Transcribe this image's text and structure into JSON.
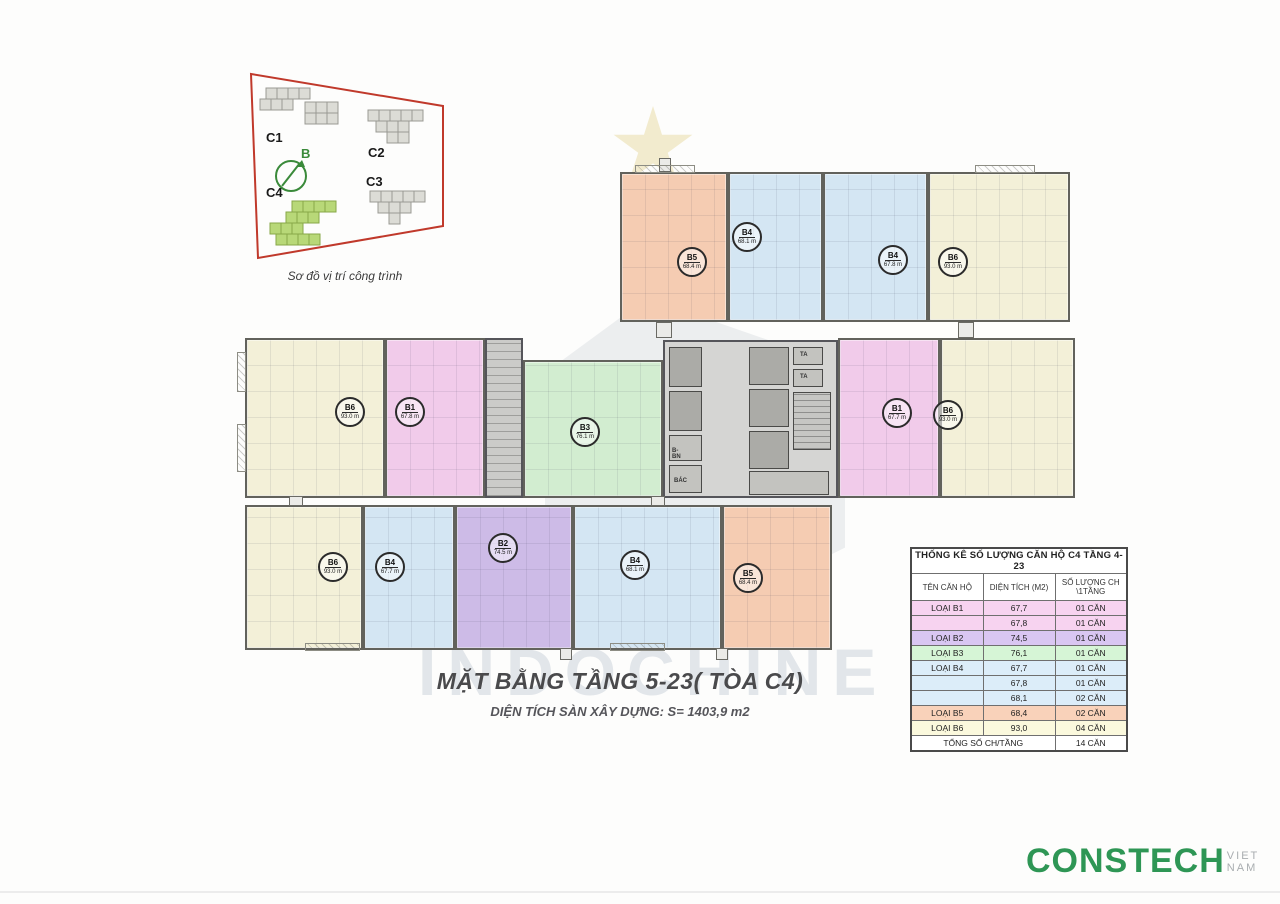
{
  "site_plan": {
    "caption": "Sơ đồ vị trí công trình",
    "labels": {
      "c1": "C1",
      "c2": "C2",
      "c3": "C3",
      "c4": "C4",
      "north": "B"
    }
  },
  "plan": {
    "units": [
      {
        "type": "B5",
        "area": "68.4 m",
        "color": "salmon",
        "x": 620,
        "y": 172,
        "w": 108,
        "h": 150,
        "bx": 692,
        "by": 262
      },
      {
        "type": "B4",
        "area": "68.1 m",
        "color": "blue",
        "x": 728,
        "y": 172,
        "w": 95,
        "h": 150,
        "bx": 747,
        "by": 237
      },
      {
        "type": "B4",
        "area": "67.8 m",
        "color": "blue",
        "x": 823,
        "y": 172,
        "w": 105,
        "h": 150,
        "bx": 893,
        "by": 260
      },
      {
        "type": "B6",
        "area": "93.0 m",
        "color": "yellow",
        "x": 928,
        "y": 172,
        "w": 142,
        "h": 150,
        "bx": 953,
        "by": 262
      },
      {
        "type": "B6",
        "area": "93.0 m",
        "color": "yellow",
        "x": 245,
        "y": 338,
        "w": 140,
        "h": 160,
        "bx": 350,
        "by": 412
      },
      {
        "type": "B1",
        "area": "67.8 m",
        "color": "pink",
        "x": 385,
        "y": 338,
        "w": 100,
        "h": 160,
        "bx": 410,
        "by": 412
      },
      {
        "type": "B3",
        "area": "76.1 m",
        "color": "green",
        "x": 523,
        "y": 360,
        "w": 140,
        "h": 138,
        "bx": 585,
        "by": 432
      },
      {
        "type": "B1",
        "area": "67.7 m",
        "color": "pink",
        "x": 838,
        "y": 338,
        "w": 102,
        "h": 160,
        "bx": 897,
        "by": 413
      },
      {
        "type": "B6",
        "area": "93.0 m",
        "color": "yellow",
        "x": 940,
        "y": 338,
        "w": 135,
        "h": 160,
        "bx": 948,
        "by": 415
      },
      {
        "type": "B6",
        "area": "93.0 m",
        "color": "yellow",
        "x": 245,
        "y": 505,
        "w": 118,
        "h": 145,
        "bx": 333,
        "by": 567
      },
      {
        "type": "B4",
        "area": "67.7 m",
        "color": "blue",
        "x": 363,
        "y": 505,
        "w": 92,
        "h": 145,
        "bx": 390,
        "by": 567
      },
      {
        "type": "B2",
        "area": "74.5 m",
        "color": "purple",
        "x": 455,
        "y": 505,
        "w": 118,
        "h": 145,
        "bx": 503,
        "by": 548
      },
      {
        "type": "B4",
        "area": "68.1 m",
        "color": "blue",
        "x": 573,
        "y": 505,
        "w": 149,
        "h": 145,
        "bx": 635,
        "by": 565
      },
      {
        "type": "B5",
        "area": "68.4 m",
        "color": "salmon",
        "x": 722,
        "y": 505,
        "w": 110,
        "h": 145,
        "bx": 748,
        "by": 578
      }
    ],
    "core_labels": [
      {
        "t": "TA",
        "x": 800,
        "y": 352
      },
      {
        "t": "TA",
        "x": 800,
        "y": 374
      },
      {
        "t": "B-BN",
        "x": 672,
        "y": 448
      },
      {
        "t": "BÁC",
        "x": 674,
        "y": 478
      }
    ]
  },
  "watermark": {
    "text": "INDOCHINE"
  },
  "title_block": {
    "title": "MẶT BẰNG TẦNG 5-23( TÒA C4)",
    "subtitle": "DIỆN TÍCH SÀN XÂY DỰNG: S= 1403,9 m2"
  },
  "stats_table": {
    "title": "THỐNG KÊ SỐ LƯỢNG CĂN HỘ C4 TẦNG 4-23",
    "headers": [
      "TÊN CĂN HỘ",
      "DIỆN TÍCH (M2)",
      "SỐ LƯỢNG CH\n\\1TẦNG"
    ],
    "rows": [
      {
        "name": "LOẠI B1",
        "area": "67,7",
        "count": "01 CĂN",
        "color": "pink"
      },
      {
        "name": "",
        "area": "67,8",
        "count": "01 CĂN",
        "color": "pink"
      },
      {
        "name": "LOẠI B2",
        "area": "74,5",
        "count": "01 CĂN",
        "color": "purple"
      },
      {
        "name": "LOẠI B3",
        "area": "76,1",
        "count": "01 CĂN",
        "color": "green"
      },
      {
        "name": "LOẠI B4",
        "area": "67,7",
        "count": "01 CĂN",
        "color": "blue"
      },
      {
        "name": "",
        "area": "67,8",
        "count": "01 CĂN",
        "color": "blue"
      },
      {
        "name": "",
        "area": "68,1",
        "count": "02 CĂN",
        "color": "blue"
      },
      {
        "name": "LOẠI B5",
        "area": "68,4",
        "count": "02 CĂN",
        "color": "salmon"
      },
      {
        "name": "LOẠI B6",
        "area": "93,0",
        "count": "04 CĂN",
        "color": "yellow"
      }
    ],
    "footer_row": {
      "label": "TỔNG SỐ CH/TẦNG",
      "value": "14 CĂN"
    }
  },
  "footer": {
    "brand": "CONSTECH",
    "brand_suffix": "VIET NAM"
  },
  "colors": {
    "accent_red": "#c0392b",
    "accent_green": "#3a8a3a",
    "brand_green": "#2e9655",
    "unit_salmon": "#f5ccb2",
    "unit_blue": "#d4e6f3",
    "unit_yellow": "#f3f0d8",
    "unit_pink": "#f1cbea",
    "unit_purple": "#cdbbe7",
    "unit_green": "#d2edd0"
  }
}
